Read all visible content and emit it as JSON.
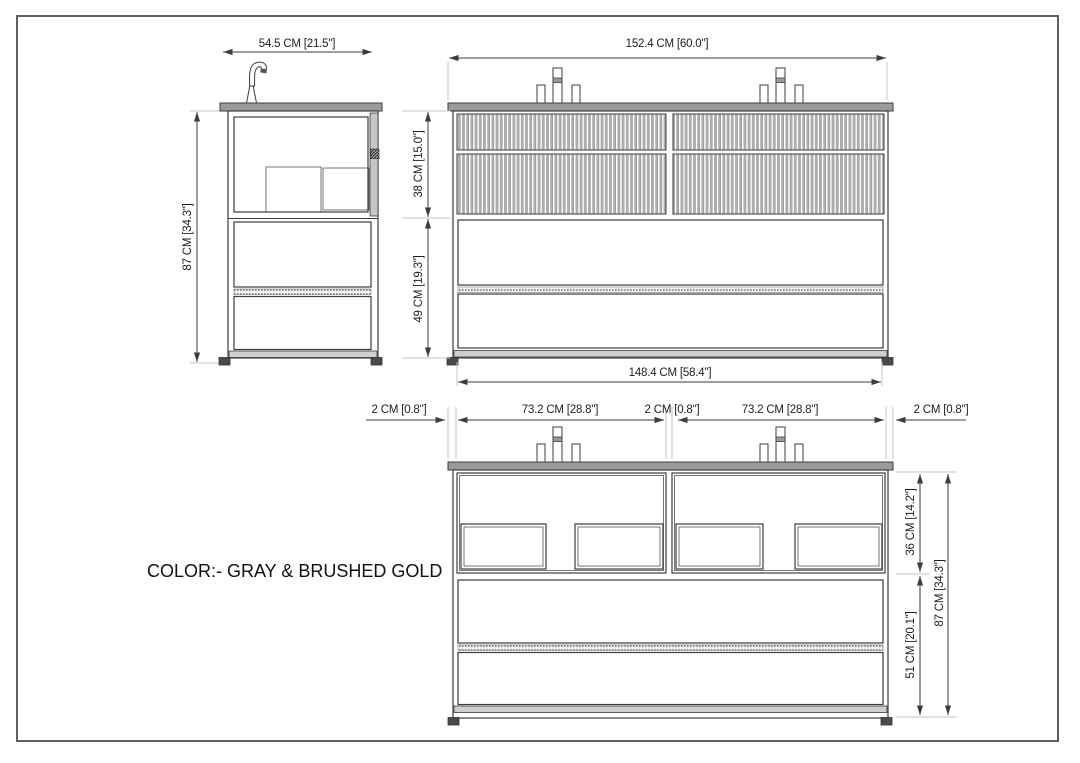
{
  "page": {
    "color_note": "COLOR:- GRAY & BRUSHED GOLD"
  },
  "side_view": {
    "width_dim": "54.5 CM [21.5\"]",
    "height_dim": "87 CM [34.3\"]"
  },
  "front_view": {
    "width_dim": "152.4 CM [60.0\"]",
    "drawer_section_height_dim": "38 CM [15.0\"]",
    "open_section_height_dim": "49 CM [19.3\"]",
    "base_width_dim": "148.4 CM [58.4\"]"
  },
  "detail_view": {
    "left_overhang_dim": "2 CM [0.8\"]",
    "left_module_width_dim": "73.2 CM [28.8\"]",
    "center_gap_dim": "2 CM [0.8\"]",
    "right_module_width_dim": "73.2 CM [28.8\"]",
    "right_overhang_dim": "2 CM [0.8\"]",
    "drawer_section_height_dim": "36 CM [14.2\"]",
    "open_section_height_dim": "51 CM [20.1\"]",
    "total_height_dim": "87 CM [34.3\"]"
  },
  "colors": {
    "countertop_gray": "#9b9b9b",
    "line_dark": "#3d3d3d",
    "flute_gray": "#aeaeae",
    "foot_dark": "#4a4a4a"
  }
}
